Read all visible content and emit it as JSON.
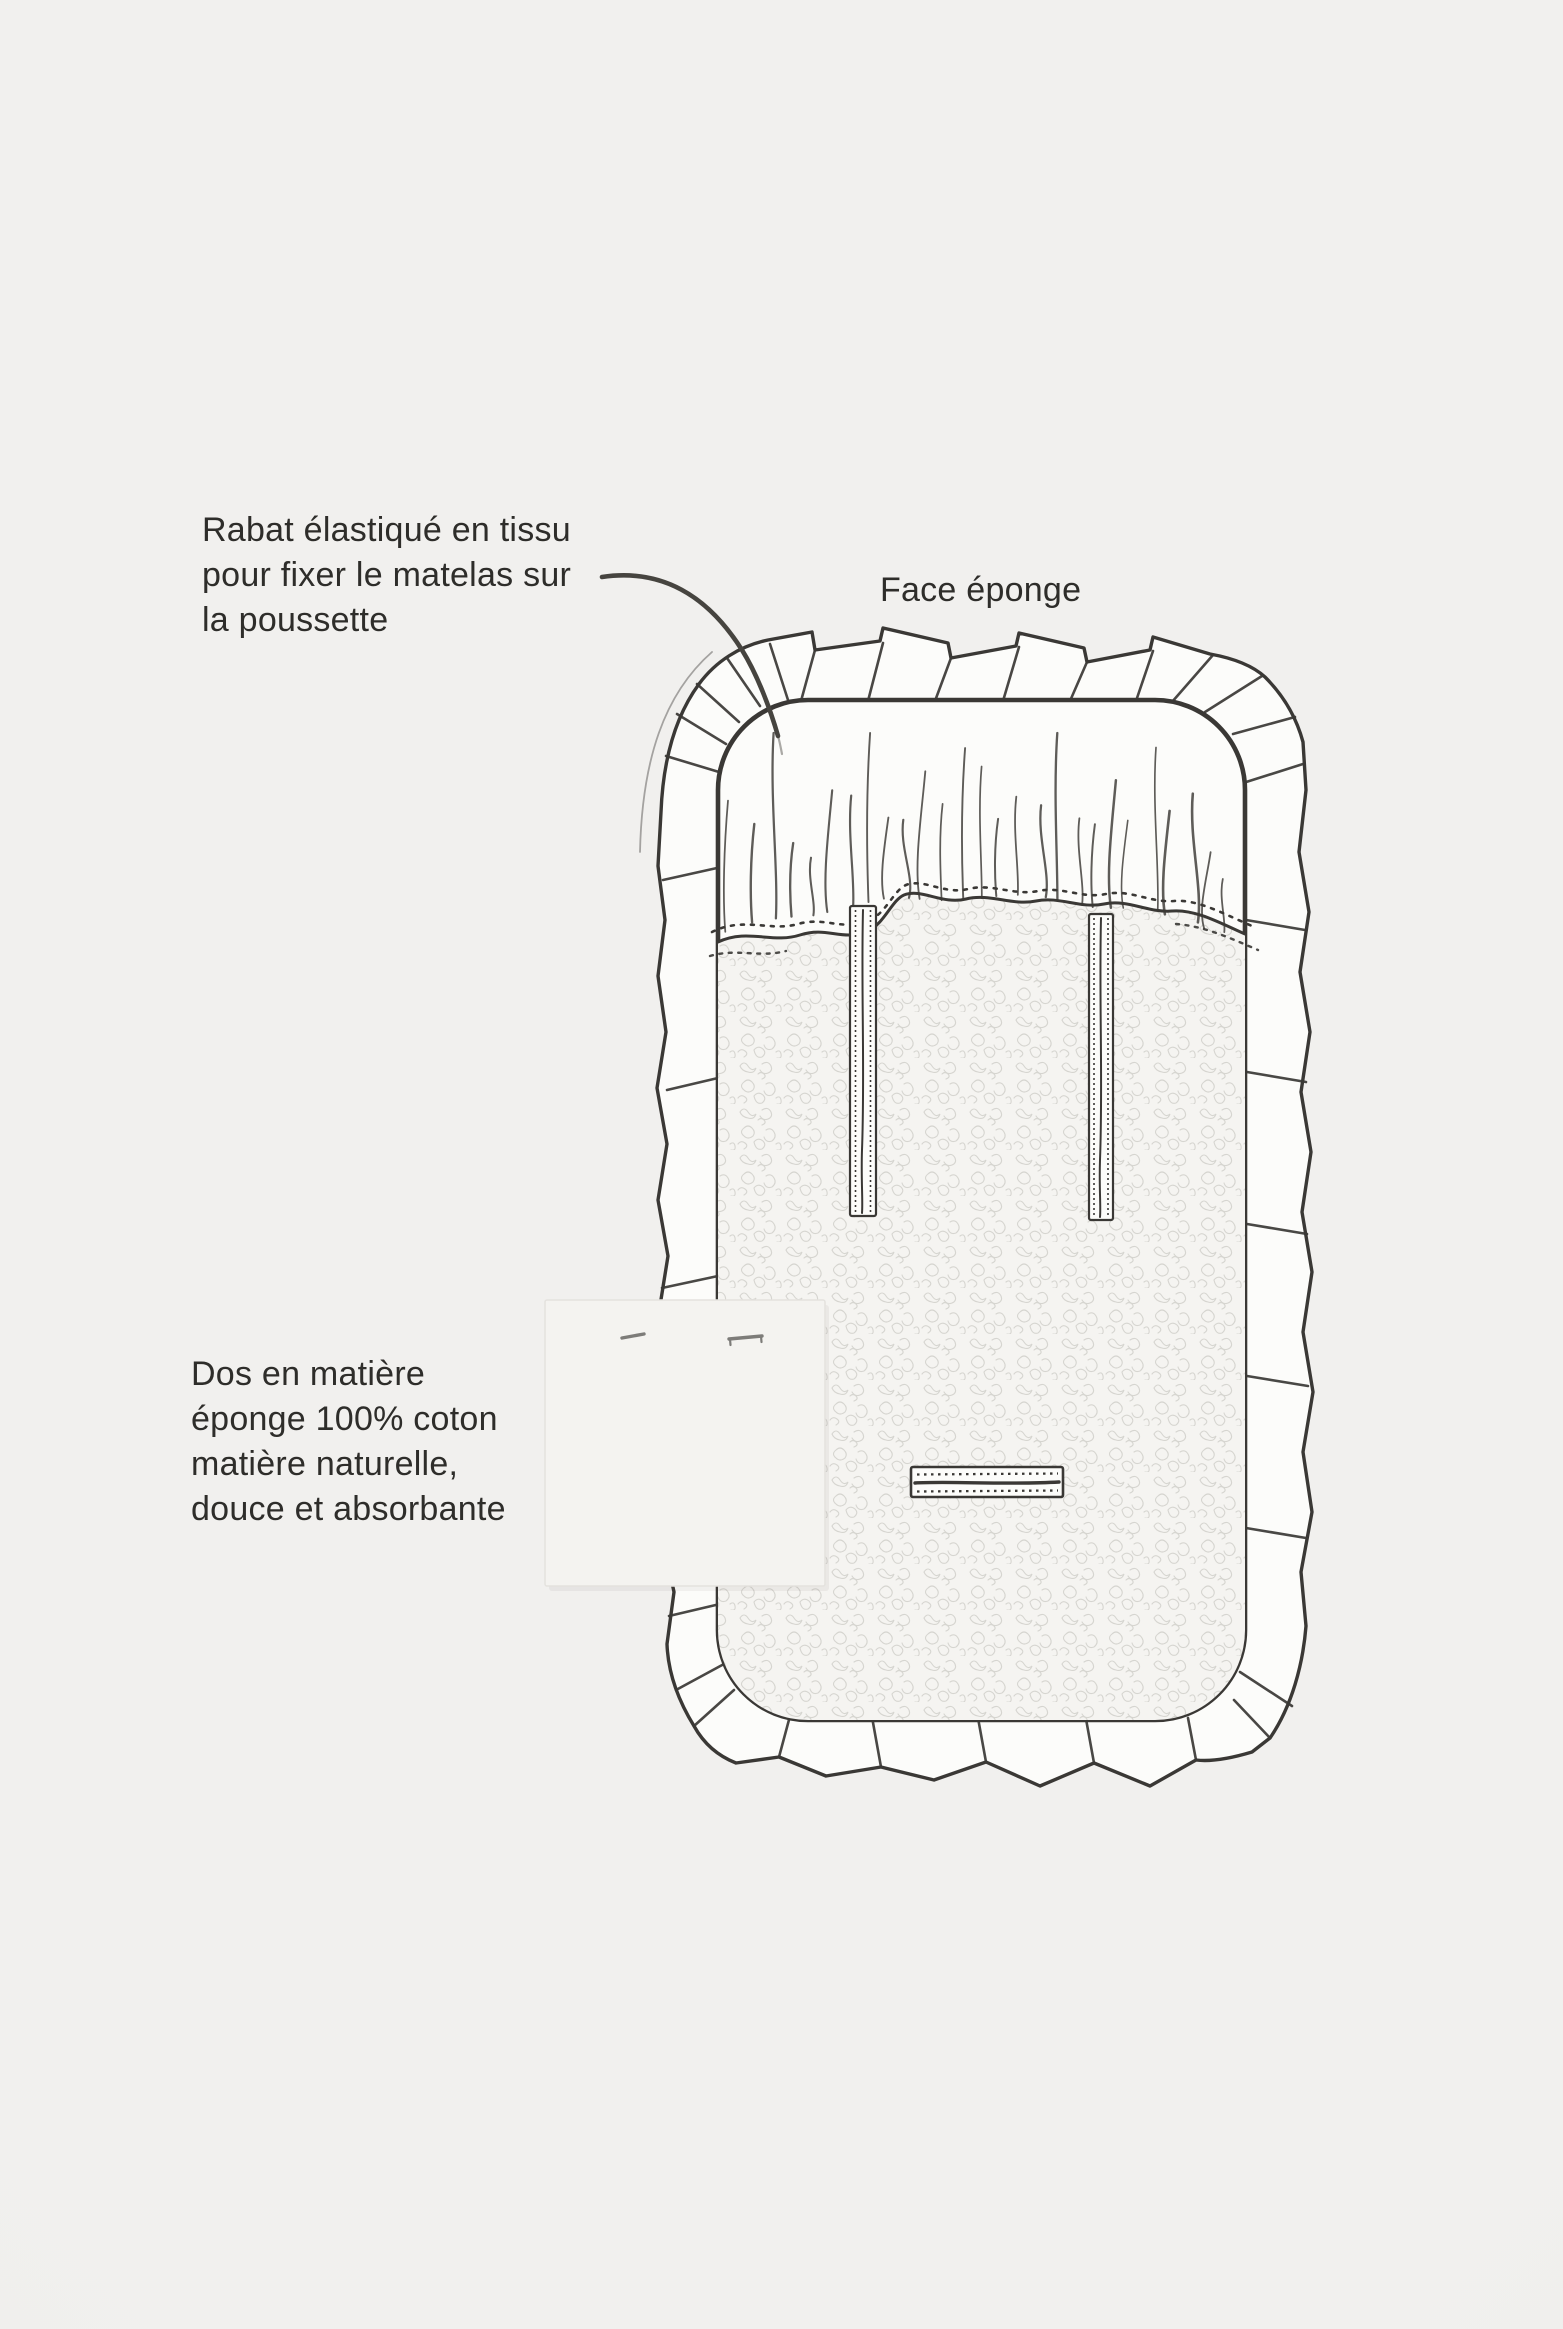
{
  "page": {
    "background": "#f1f0ee",
    "vignette_edge": "#eceae7"
  },
  "colors": {
    "ink": "#3a3835",
    "text": "#2e2d2a",
    "paper": "#fcfcfa",
    "terry_fill": "#f5f4f1",
    "terry_loop": "#d6d5d0",
    "swatch_fill": "#f4f3f0",
    "swatch_edge": "#e4e2de",
    "staple": "#7d7c79"
  },
  "annotations": {
    "flap_note": {
      "lines": [
        "Rabat élastiqué en tissu",
        "pour fixer le matelas sur",
        "la poussette"
      ]
    },
    "face_label": "Face éponge",
    "back_note": {
      "lines": [
        "Dos en matière",
        "éponge 100% coton",
        "matière naturelle,",
        "douce et absorbante"
      ]
    }
  },
  "illustration": {
    "parts": [
      "ruffle-border",
      "elastic-flap",
      "gather-seam",
      "terry-face",
      "strap-slot-left",
      "strap-slot-right",
      "buckle-slot",
      "fabric-swatch",
      "leader-line"
    ]
  }
}
